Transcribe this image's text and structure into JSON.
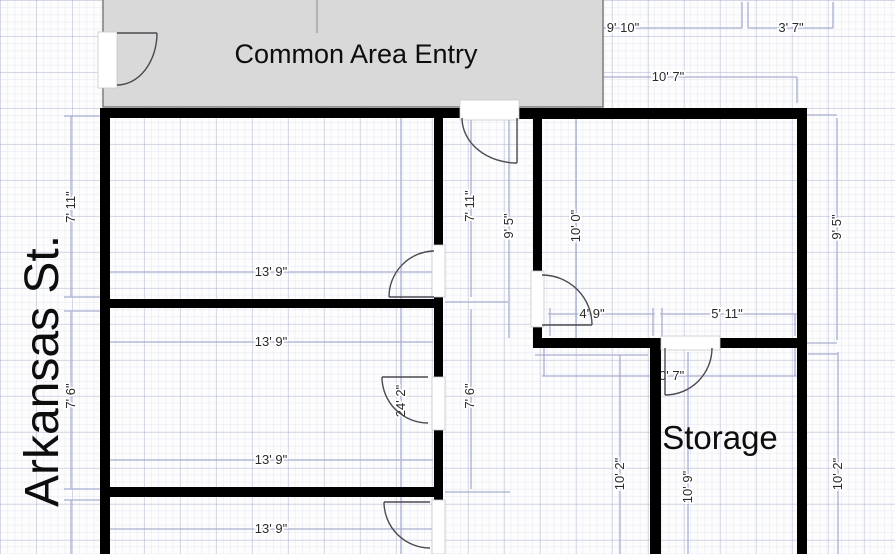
{
  "street": {
    "label": "Arkansas St."
  },
  "common_area": {
    "label": "Common Area Entry"
  },
  "storage": {
    "label": "Storage"
  },
  "dim": {
    "top_left_width": "9' 10\"",
    "top_right_width": "3' 7\"",
    "right_room_width": "10' 7\"",
    "room1_height_street": "7' 11\"",
    "room1_height_hall": "7' 11\"",
    "hall_height_upper": "9' 5\"",
    "right_room_height_inner": "10' 0\"",
    "right_room_height_outer": "9' 5\"",
    "room1_width": "13' 9\"",
    "room2_width_top": "13' 9\"",
    "room2_width_bottom": "13' 9\"",
    "room3_width": "13' 9\"",
    "room2_height_street": "7' 6\"",
    "room2_height_hall": "7' 6\"",
    "hall_height_total": "24' 2\"",
    "nook_width": "4' 9\"",
    "storage_width": "5' 11\"",
    "storage_full_width": "10' 7\"",
    "open_area_height": "10' 2\"",
    "storage_height": "10' 9\"",
    "right_area_height": "10' 2\""
  },
  "colors": {
    "wall": "#000000",
    "dimension": "#a8aed0",
    "common_area_fill": "#d9d9d9",
    "text": "#2a2a2a"
  }
}
